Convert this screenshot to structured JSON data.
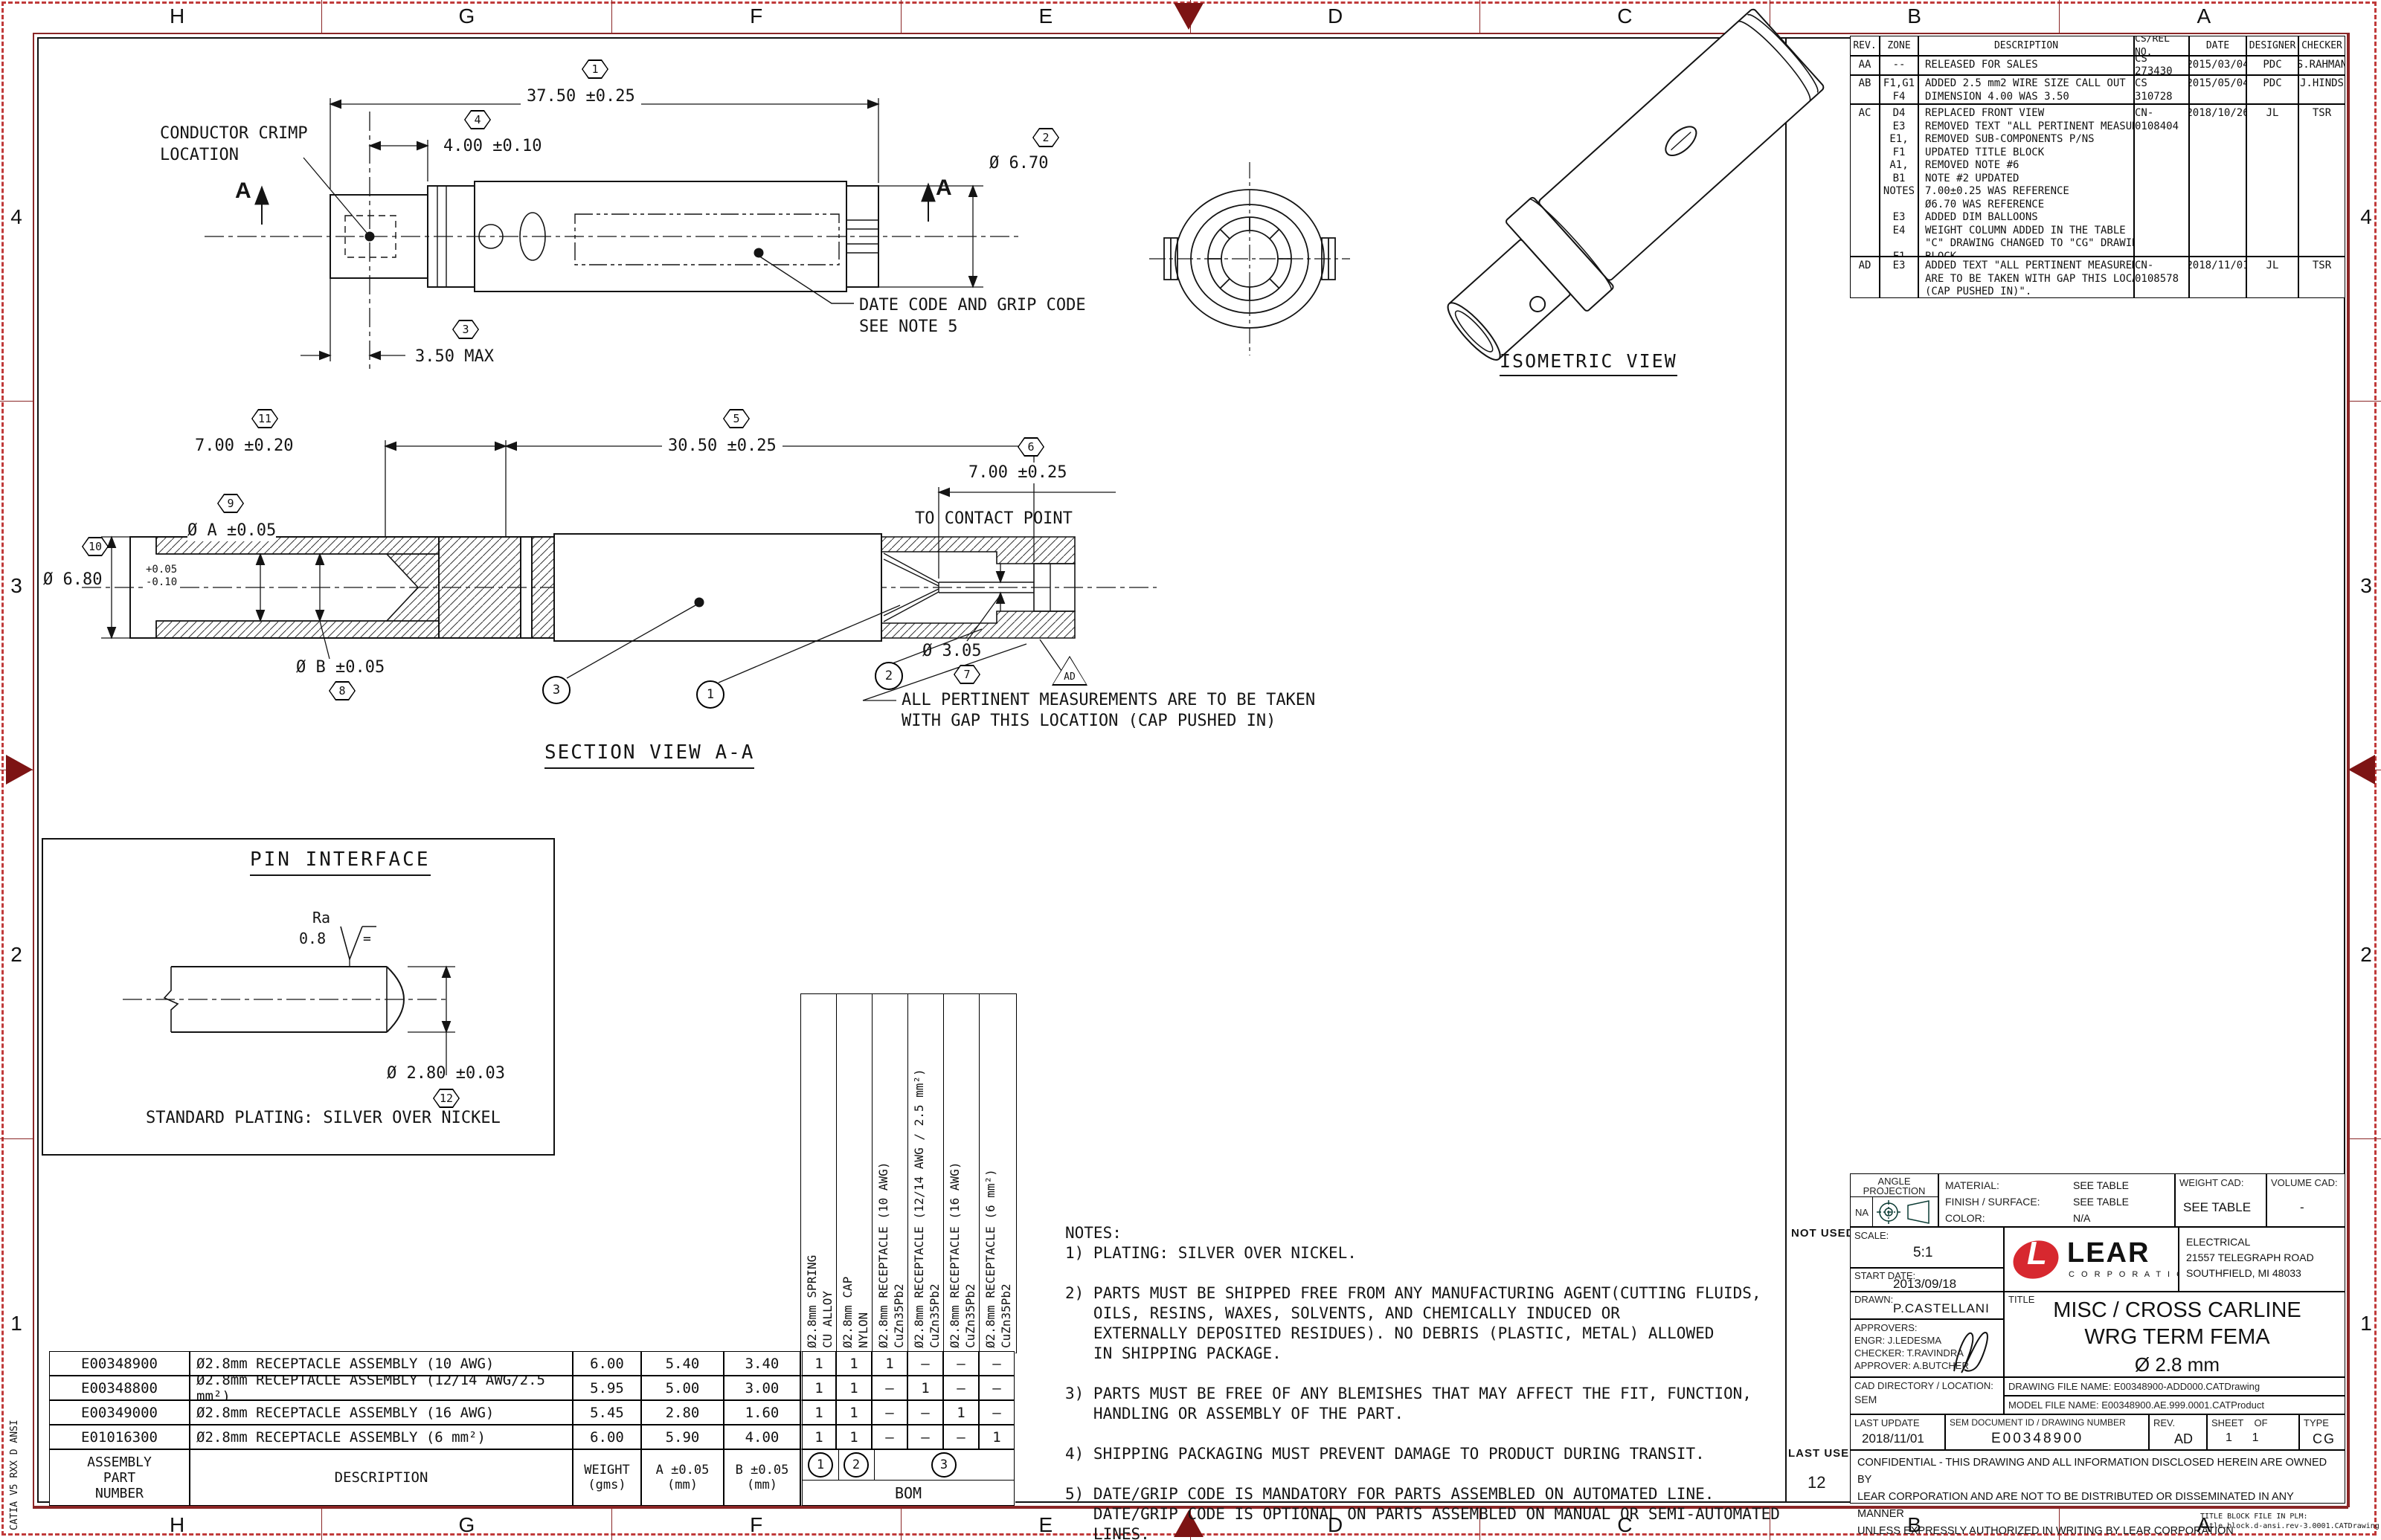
{
  "zones": {
    "top": [
      "H",
      "G",
      "F",
      "E",
      "D",
      "C",
      "B",
      "A"
    ],
    "bottom": [
      "H",
      "G",
      "F",
      "E",
      "D",
      "C",
      "B",
      "A"
    ],
    "left": [
      "4",
      "3",
      "2",
      "1"
    ],
    "right": [
      "4",
      "3",
      "2",
      "1"
    ]
  },
  "misc": {
    "side_text": "CATIA V5 RXX D ANSI",
    "not_used": "NOT USED",
    "last_used": "LAST USED",
    "last_used_value": "12",
    "corner_note": "TITLE BLOCK FILE IN PLM:\ntitle.block.d-ansi.rev-3.0001.CATDrawing"
  },
  "balloons": {
    "n1": "1",
    "n2": "2",
    "n3": "3",
    "n4": "4",
    "n5": "5",
    "n6": "6",
    "n7": "7",
    "n8": "8",
    "n9": "9",
    "n10": "10",
    "n11": "11",
    "n12": "12",
    "flag": "AD"
  },
  "front": {
    "dim_overall": "37.50 ±0.25",
    "dim_crimp": "4.00 ±0.10",
    "crimp_label": "CONDUCTOR CRIMP\nLOCATION",
    "sec_a": "A",
    "dia": "Ø 6.70",
    "max": "3.50 MAX",
    "datecode": "DATE CODE AND GRIP CODE\nSEE NOTE 5"
  },
  "iso": {
    "label": "ISOMETRIC VIEW"
  },
  "section": {
    "d1": "7.00 ±0.20",
    "d2": "30.50 ±0.25",
    "d3": "7.00 ±0.25",
    "d3b": "TO CONTACT POINT",
    "d4": "Ø 6.80",
    "d4tol": "+0.05\n-0.10",
    "d5": "Ø A ±0.05",
    "d6": "Ø B ±0.05",
    "d7": "Ø 3.05",
    "note": "ALL PERTINENT MEASUREMENTS ARE TO BE TAKEN\nWITH GAP THIS LOCATION (CAP PUSHED IN)",
    "label": "SECTION VIEW A-A"
  },
  "pin": {
    "title": "PIN INTERFACE",
    "ra": "Ra",
    "ra_val": "0.8",
    "eq": "=",
    "dia": "Ø 2.80 ±0.03",
    "plating": "STANDARD PLATING: SILVER OVER NICKEL"
  },
  "notes": {
    "text": "NOTES:\n1) PLATING: SILVER OVER NICKEL.\n\n2) PARTS MUST BE SHIPPED FREE FROM ANY MANUFACTURING AGENT(CUTTING FLUIDS,\n   OILS, RESINS, WAXES, SOLVENTS, AND CHEMICALLY INDUCED OR\n   EXTERNALLY DEPOSITED RESIDUES). NO DEBRIS (PLASTIC, METAL) ALLOWED\n   IN SHIPPING PACKAGE.\n\n3) PARTS MUST BE FREE OF ANY BLEMISHES THAT MAY AFFECT THE FIT, FUNCTION,\n   HANDLING OR ASSEMBLY OF THE PART.\n\n4) SHIPPING PACKAGING MUST PREVENT DAMAGE TO PRODUCT DURING TRANSIT.\n\n5) DATE/GRIP CODE IS MANDATORY FOR PARTS ASSEMBLED ON AUTOMATED LINE.\n   DATE/GRIP CODE IS OPTIONAL ON PARTS ASSEMBLED ON MANUAL OR SEMI-AUTOMATED\n   LINES."
  },
  "bom": {
    "rows": [
      {
        "part": "E00348900",
        "desc": "Ø2.8mm RECEPTACLE ASSEMBLY (10 AWG)",
        "weight": "6.00",
        "a": "5.40",
        "b": "3.40",
        "qty": [
          "1",
          "1",
          "1",
          "–",
          "–",
          "–"
        ]
      },
      {
        "part": "E00348800",
        "desc": "Ø2.8mm RECEPTACLE ASSEMBLY (12/14 AWG/2.5 mm²)",
        "weight": "5.95",
        "a": "5.00",
        "b": "3.00",
        "qty": [
          "1",
          "1",
          "–",
          "1",
          "–",
          "–"
        ]
      },
      {
        "part": "E00349000",
        "desc": "Ø2.8mm RECEPTACLE ASSEMBLY (16 AWG)",
        "weight": "5.45",
        "a": "2.80",
        "b": "1.60",
        "qty": [
          "1",
          "1",
          "–",
          "–",
          "1",
          "–"
        ]
      },
      {
        "part": "E01016300",
        "desc": "Ø2.8mm RECEPTACLE ASSEMBLY (6 mm²)",
        "weight": "6.00",
        "a": "5.90",
        "b": "4.00",
        "qty": [
          "1",
          "1",
          "–",
          "–",
          "–",
          "1"
        ]
      }
    ],
    "footer": {
      "part": "ASSEMBLY\nPART\nNUMBER",
      "desc": "DESCRIPTION",
      "weight": "WEIGHT\n(gms)",
      "a": "A ±0.05\n(mm)",
      "b": "B ±0.05\n(mm)",
      "bom_label": "BOM"
    },
    "component_headers": [
      "Ø2.8mm SPRING\nCU ALLOY",
      "Ø2.8mm CAP\nNYLON",
      "Ø2.8mm RECEPTACLE (10 AWG)\nCuZn35Pb2",
      "Ø2.8mm RECEPTACLE (12/14 AWG / 2.5 mm²)\nCuZn35Pb2",
      "Ø2.8mm RECEPTACLE (16 AWG)\nCuZn35Pb2",
      "Ø2.8mm RECEPTACLE (6 mm²)\nCuZn35Pb2"
    ]
  },
  "rev_table": {
    "headers": [
      "REV.",
      "ZONE",
      "DESCRIPTION",
      "CS/REL NO.",
      "DATE",
      "DESIGNER",
      "CHECKER"
    ],
    "rows": [
      {
        "rev": "AA",
        "zone": "--",
        "desc": "RELEASED FOR SALES",
        "cs": "CS 273430",
        "date": "2015/03/04",
        "designer": "PDC",
        "checker": "S.RAHMAN"
      },
      {
        "rev": "AB",
        "zone": "F1,G1\nF4",
        "desc": "ADDED 2.5 mm2 WIRE SIZE CALL OUT\nDIMENSION 4.00 WAS 3.50",
        "cs": "CS 310728",
        "date": "2015/05/04",
        "designer": "PDC",
        "checker": "J.HINDS"
      },
      {
        "rev": "AC",
        "zone": "D4\nE3\nE1, F1\nA1, B1\nNOTES\n\nE3\nE4\n\nF1",
        "desc": "REPLACED FRONT VIEW\nREMOVED TEXT \"ALL PERTINENT MEASUREMENTS...\"\nREMOVED SUB-COMPONENTS P/NS\nUPDATED TITLE BLOCK\nREMOVED NOTE #6\nNOTE #2 UPDATED\n7.00±0.25 WAS REFERENCE\nØ6.70 WAS REFERENCE\nADDED DIM BALLOONS\nWEIGHT COLUMN ADDED IN THE TABLE\n\"C\" DRAWING CHANGED TO \"CG\" DRAWING IN TITLE\nBLOCK",
        "cs": "CN-0108404",
        "date": "2018/10/26",
        "designer": "JL",
        "checker": "TSR"
      },
      {
        "rev": "AD",
        "zone": "E3",
        "desc": "ADDED TEXT \"ALL PERTINENT MEASUREMENTS\nARE TO BE TAKEN WITH GAP THIS LOCATION\n(CAP PUSHED IN)\".",
        "cs": "CN-0108578",
        "date": "2018/11/01",
        "designer": "JL",
        "checker": "TSR"
      }
    ]
  },
  "title_block": {
    "angle_projection": "ANGLE\nPROJECTION",
    "na": "NA",
    "material_label": "MATERIAL:",
    "material": "SEE TABLE",
    "finish_label": "FINISH / SURFACE:",
    "finish": "SEE TABLE",
    "color_label": "COLOR:",
    "color": "N/A",
    "weight_cad_label": "WEIGHT CAD:",
    "weight_cad": "SEE TABLE",
    "volume_cad_label": "VOLUME CAD:",
    "volume_cad": "-",
    "scale_label": "SCALE:",
    "scale": "5:1",
    "start_date_label": "START DATE:",
    "start_date": "2013/09/18",
    "drawn_label": "DRAWN:",
    "drawn": "P.CASTELLANI",
    "approv_label": "APPROVERS:",
    "approv1": "ENGR: J.LEDESMA",
    "approv2": "CHECKER: T.RAVINDRA",
    "approv3": "APPROVER: A.BUTCHER",
    "lear": "LEAR",
    "lear_l": "L",
    "lear_sub": "C O R P O R A T I O N",
    "address": "ELECTRICAL\n21557 TELEGRAPH ROAD\nSOUTHFIELD, MI  48033",
    "title_label": "TITLE",
    "title_line1": "MISC / CROSS CARLINE",
    "title_line2": "WRG TERM FEMA",
    "title_line3": "Ø 2.8 mm",
    "cad_dir_label": "CAD DIRECTORY / LOCATION:",
    "cad_dir": "SEM",
    "drawing_file": "DRAWING FILE NAME: E00348900-ADD000.CATDrawing",
    "model_file": "MODEL FILE NAME: E00348900.AE.999.0001.CATProduct",
    "last_update_label": "LAST UPDATE",
    "last_update": "2018/11/01",
    "doc_id_label": "SEM DOCUMENT ID / DRAWING NUMBER",
    "doc_id": "E00348900",
    "rev_label": "REV.",
    "rev": "AD",
    "sheet_label": "SHEET    OF",
    "sheet": "1      1",
    "type_label": "TYPE",
    "type": "CG",
    "confidential": "CONFIDENTIAL - THIS DRAWING AND ALL INFORMATION DISCLOSED HEREIN ARE OWNED BY\nLEAR CORPORATION AND ARE NOT TO BE DISTRIBUTED OR DISSEMINATED IN ANY MANNER\nUNLESS EXPRESSLY AUTHORIZED IN WRITING BY LEAR CORPORATION"
  }
}
